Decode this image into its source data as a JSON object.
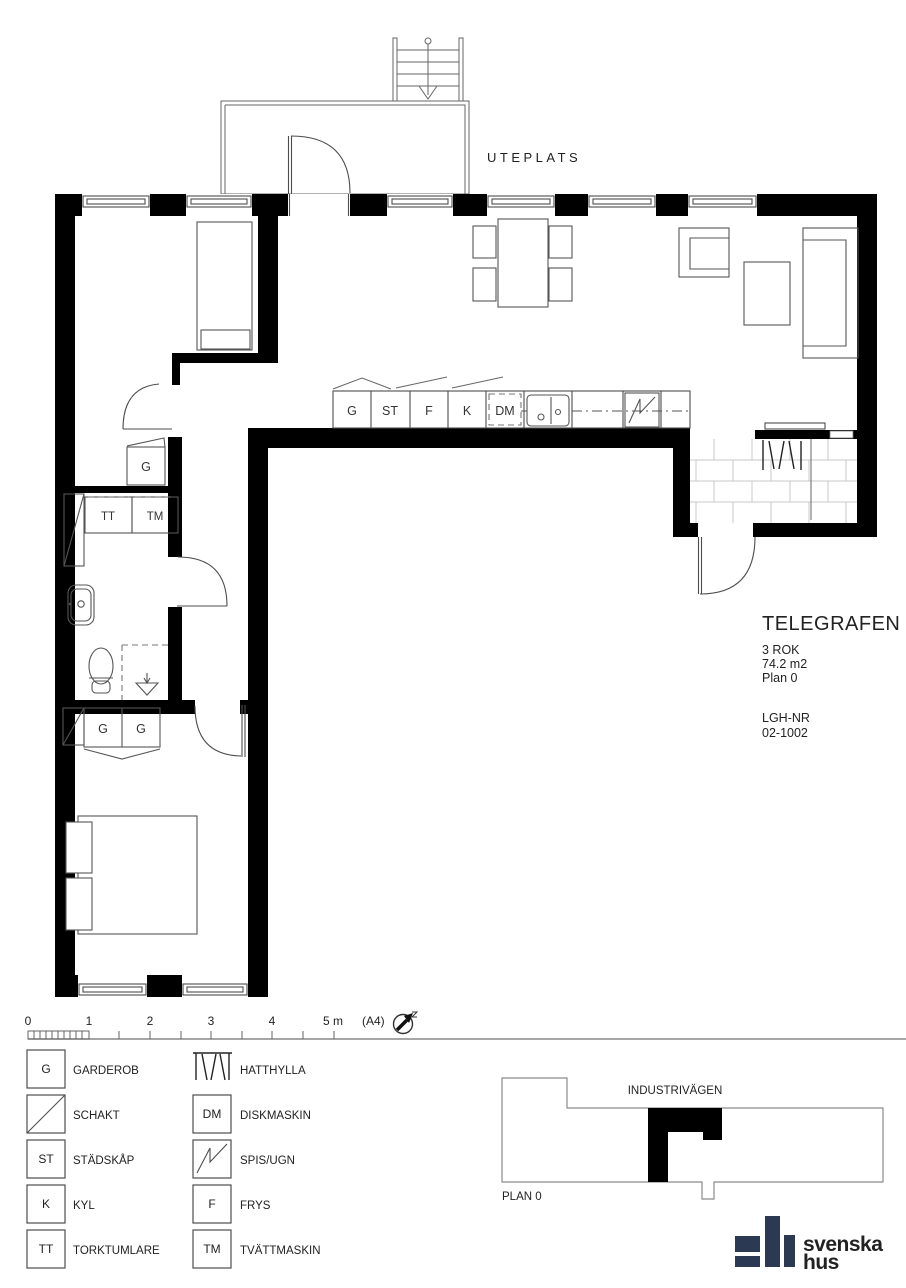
{
  "colors": {
    "wall": "#000000",
    "line": "#4d4d4d",
    "brick_line": "#c9c9c9",
    "logo": "#2b3a52"
  },
  "plan": {
    "outdoor_label": "UTEPLATS",
    "kitchen": {
      "u1": "G",
      "u2": "ST",
      "u3": "F",
      "u4": "K",
      "u5": "DM"
    },
    "laundry": {
      "dryer": "TT",
      "washer": "TM"
    },
    "hall_closet": "G",
    "bedroom_closets": {
      "c1": "G",
      "c2": "G"
    }
  },
  "info": {
    "title": "TELEGRAFEN",
    "rooms": "3 ROK",
    "area": "74.2 m2",
    "floor": "Plan 0",
    "unit_label": "LGH-NR",
    "unit_number": "02-1002"
  },
  "scale_bar": {
    "m0": "0",
    "m1": "1",
    "m2": "2",
    "m3": "3",
    "m4": "4",
    "m5": "5 m",
    "paper": "(A4)"
  },
  "legend": {
    "items": [
      {
        "symbol": "G",
        "label": "GARDEROB"
      },
      {
        "symbol": "",
        "label": "SCHAKT"
      },
      {
        "symbol": "ST",
        "label": "STÄDSKÅP"
      },
      {
        "symbol": "K",
        "label": "KYL"
      },
      {
        "symbol": "TT",
        "label": "TORKTUMLARE"
      },
      {
        "symbol": "",
        "label": "HATTHYLLA"
      },
      {
        "symbol": "DM",
        "label": "DISKMASKIN"
      },
      {
        "symbol": "",
        "label": "SPIS/UGN"
      },
      {
        "symbol": "F",
        "label": "FRYS"
      },
      {
        "symbol": "TM",
        "label": "TVÄTTMASKIN"
      }
    ]
  },
  "site_plan": {
    "street": "INDUSTRIVÄGEN",
    "floor_label": "PLAN 0"
  },
  "logo": {
    "word1": "svenska",
    "word2": "hus"
  }
}
